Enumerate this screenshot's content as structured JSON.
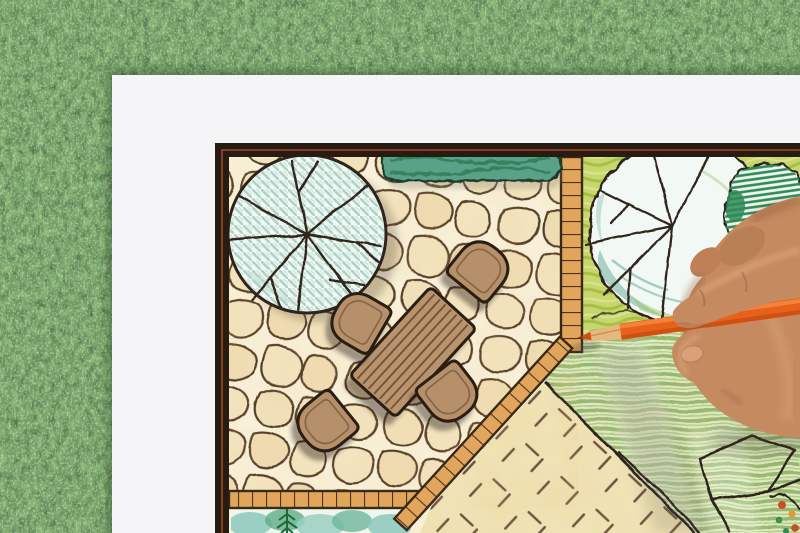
{
  "scene": {
    "type": "photograph",
    "description": "Overhead photo of a right hand drawing a landscape-architecture garden plan with an orange colored pencil; the white plan sheet lies on green grass",
    "background": "green grass lawn",
    "paper": "white plan sheet",
    "plan": {
      "frame": "thick dark border with thin maroon pinstripe",
      "elements": [
        {
          "name": "deciduous-tree-symbol",
          "label": "large round tree canopy with teal hatching and radiating branch lines"
        },
        {
          "name": "clipped-hedge",
          "label": "green clipped hedge strip"
        },
        {
          "name": "flagstone-patio",
          "label": "irregular flagstone paving"
        },
        {
          "name": "brick-edge",
          "label": "brick soldier-course edging and path"
        },
        {
          "name": "dining-table",
          "label": "rectangular wood-slat table"
        },
        {
          "name": "chairs",
          "label": "four wooden chairs",
          "count": 4
        },
        {
          "name": "scalloped-tree-symbol",
          "label": "round tree symbol with scalloped outline"
        },
        {
          "name": "shrub",
          "label": "hatched shrub"
        },
        {
          "name": "lawn",
          "label": "striped lawn area"
        },
        {
          "name": "stone-paving",
          "label": "beige paving with hatch tick marks"
        },
        {
          "name": "planting-bed",
          "label": "teal watercolor planting bed with conifer sprig"
        },
        {
          "name": "stepping-stones",
          "label": "angular stepping-stone outlines"
        },
        {
          "name": "flower-bed-corner",
          "label": "corner flower bed with red and orange dots"
        }
      ]
    },
    "hand": {
      "side": "right",
      "grip": "pencil held between index finger and thumb"
    },
    "pencil": {
      "kind": "colored pencil",
      "color_name": "orange"
    }
  },
  "colors": {
    "grass_base": "#3f6b33",
    "paper": "#f5f5f7",
    "frame": "#271c12",
    "pinstripe": "#8e3a28",
    "plan_bg": "#f8f0d8",
    "stone_fill": "#f2e4bf",
    "stone_outline": "#543c28",
    "brick": "#e2a55c",
    "brick_outline": "#3a2918",
    "hedge": "#5aa287",
    "hedge_dark": "#2e7a57",
    "plan_line": "#2e241b",
    "tree_fill": "#f2f8f4",
    "tree_hatch": "#a9cfc2",
    "meadow": "#c7d76c",
    "lawn_base": "#dfe9c0",
    "paving": "#efe2b4",
    "paving_tick": "#6b5340",
    "bed_teal": "#8cc8bc",
    "bed_green": "#5fae86",
    "conifer": "#1e6b3a",
    "table_wood": "#b8936d",
    "chair_wood": "#b5906a",
    "furniture_outline": "#2a1e12",
    "slat": "#6f5136",
    "pencil_body": "#e8611c",
    "pencil_light": "#f68a3c",
    "pencil_dark": "#c94e10",
    "pencil_wood": "#e7b87e",
    "pencil_lead": "#cf4f12",
    "skin": "#c58a60",
    "skin_light": "#e2ac80",
    "skin_shadow": "#935c39",
    "flower_red": "#cf4a28",
    "flower_orange": "#e09a3a",
    "shadow": "#55524a"
  }
}
